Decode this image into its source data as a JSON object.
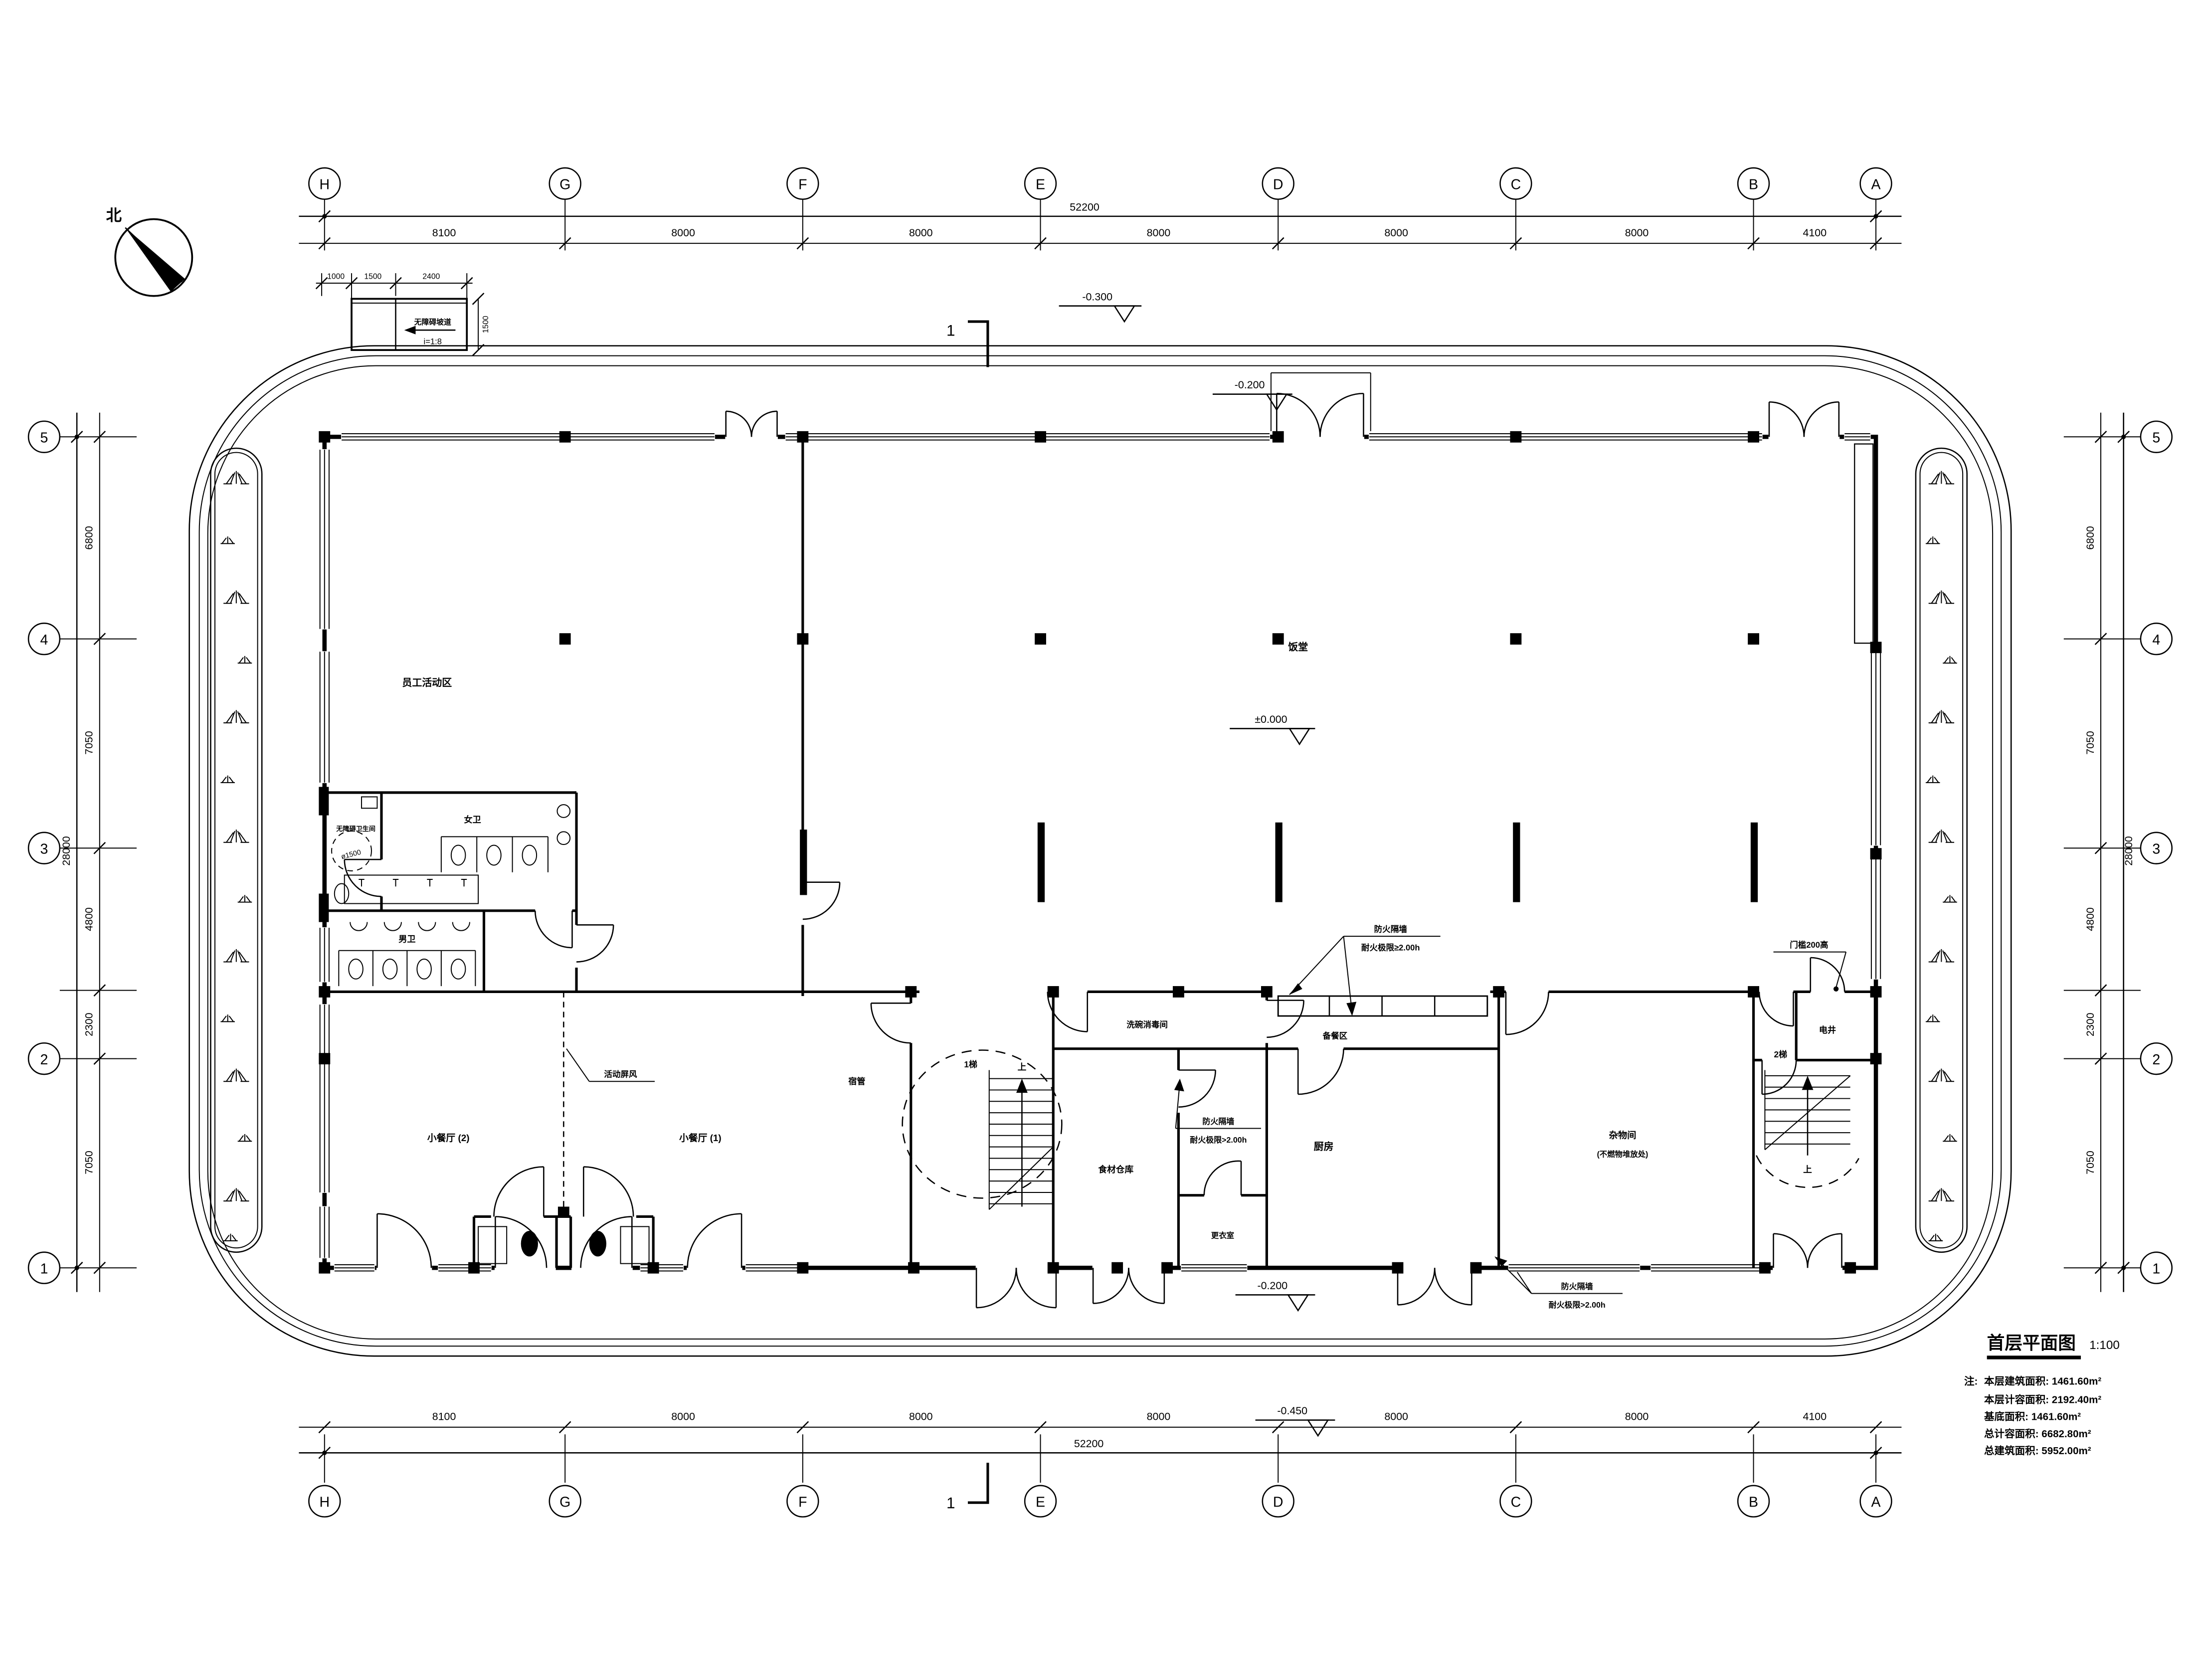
{
  "drawing": {
    "title": "首层平面图",
    "scale": "1:100",
    "note_label": "注:",
    "notes": [
      "本层建筑面积: 1461.60m²",
      "本层计容面积: 2192.40m²",
      "基底面积: 1461.60m²",
      "总计容面积: 6682.80m²",
      "总建筑面积: 5952.00m²"
    ]
  },
  "north_label": "北",
  "section_mark": "1",
  "grid": {
    "col_labels": [
      "H",
      "G",
      "F",
      "E",
      "D",
      "C",
      "B",
      "A"
    ],
    "col_dims": [
      "8100",
      "8000",
      "8000",
      "8000",
      "8000",
      "8000",
      "4100"
    ],
    "col_total": "52200",
    "row_labels": [
      "5",
      "4",
      "3",
      "2",
      "1"
    ],
    "row_dims": [
      "6800",
      "7050",
      "4800",
      "2300",
      "7050"
    ],
    "row_total": "28000"
  },
  "ramp": {
    "name": "无障碍坡道",
    "slope": "i=1:8",
    "dim1": "1000",
    "dim2": "1500",
    "dim3": "2400",
    "dim_w": "1500"
  },
  "levels": {
    "path": "-0.300",
    "north_entry": "-0.200",
    "hall": "±0.000",
    "south_entry": "-0.200",
    "site_south": "-0.450"
  },
  "rooms": {
    "staff_activity": "员工活动区",
    "dining_hall": "饭堂",
    "accessible_wc": "无障碍卫生间",
    "accessible_wc_dia": "ø1500",
    "womens_wc": "女卫",
    "mens_wc": "男卫",
    "small_dining_2": "小餐厅 (2)",
    "small_dining_1": "小餐厅 (1)",
    "movable_screen": "活动屏风",
    "dorm_admin": "宿管",
    "stair1": "1梯",
    "stair2": "2梯",
    "up": "上",
    "dish_wash": "洗碗消毒间",
    "food_storage": "食材仓库",
    "kitchen": "厨房",
    "changing": "更衣室",
    "serving": "备餐区",
    "sundries1": "杂物间",
    "sundries2": "(不燃物堆放处)",
    "elec_shaft": "电井",
    "threshold": "门槛200高"
  },
  "fire": {
    "wall": "防火隔墙",
    "rating_ge": "耐火极限≥2.00h",
    "rating_gt": "耐火极限>2.00h"
  }
}
